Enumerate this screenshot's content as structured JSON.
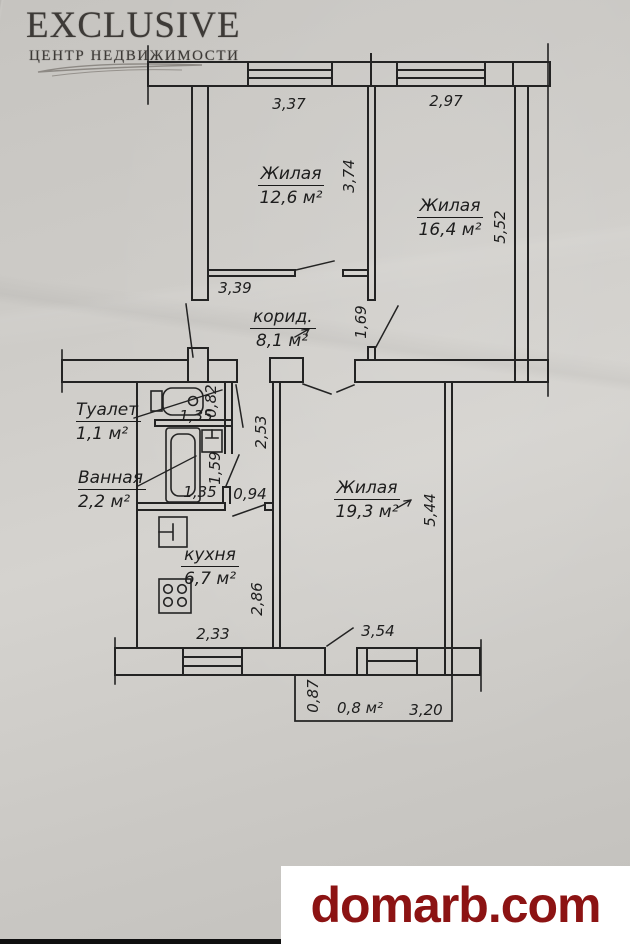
{
  "branding": {
    "agency": {
      "title": "EXCLUSIVE",
      "subtitle": "ЦЕНТР НЕДВИЖИМОСТИ"
    },
    "watermark": {
      "text": "domarb.com",
      "color": "#8c1313"
    }
  },
  "floorplan": {
    "line_color": "#232323",
    "rooms": {
      "living1": {
        "label": "Жилая",
        "area": "12,6 м²"
      },
      "living2": {
        "label": "Жилая",
        "area": "16,4 м²"
      },
      "living3": {
        "label": "Жилая",
        "area": "19,3 м²"
      },
      "corridor": {
        "label": "корид.",
        "area": "8,1 м²"
      },
      "toilet": {
        "label": "Туалет",
        "area": "1,1 м²"
      },
      "bathroom": {
        "label": "Ванная",
        "area": "2,2 м²"
      },
      "kitchen": {
        "label": "кухня",
        "area": "6,7 м²"
      },
      "balcony": {
        "area": "0,8 м²"
      }
    },
    "dimensions": {
      "top_window_left": "3,37",
      "top_window_right": "2,97",
      "living1_depth": "3,74",
      "living2_depth": "5,52",
      "living1_width": "3,39",
      "corridor_opening": "1,69",
      "toilet_depth": "0,82",
      "toilet_width": "1,35",
      "hall_depth": "2,53",
      "bath_depth": "1,59",
      "bath_width": "1,35",
      "hall_width": "0,94",
      "living3_depth": "5,44",
      "kitchen_depth": "2,86",
      "kitchen_width": "2,33",
      "living3_width": "3,54",
      "balcony_depth": "0,87",
      "balcony_width": "3,20"
    }
  }
}
